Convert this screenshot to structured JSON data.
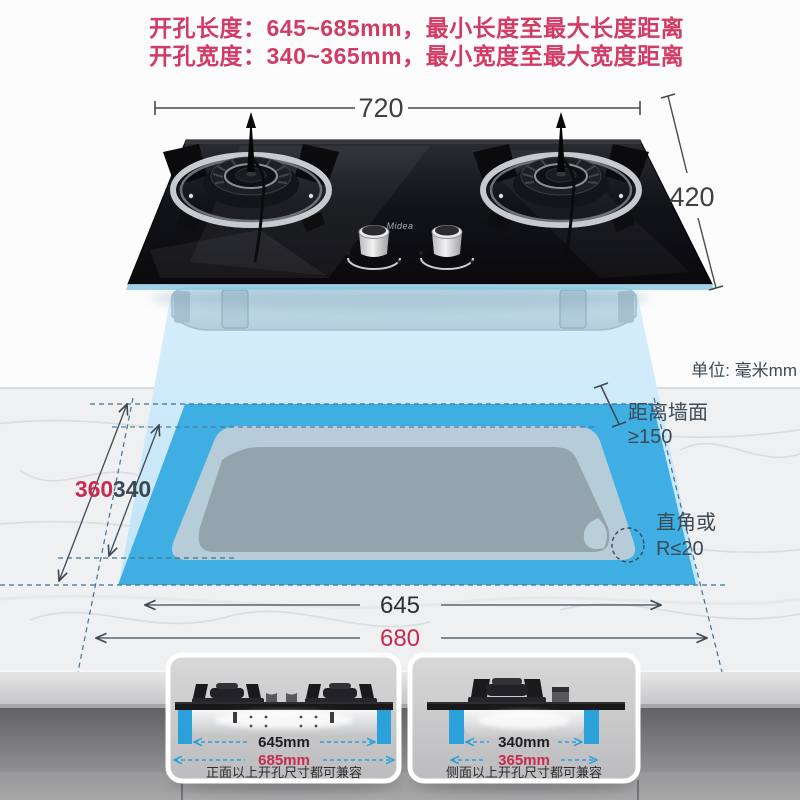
{
  "header": {
    "line1": "开孔长度：645~685mm，最小长度至最大长度距离",
    "line2": "开孔宽度：340~365mm，最小宽度至最大宽度距离"
  },
  "stove": {
    "width_label": "720",
    "depth_label": "420",
    "brand": "Midea"
  },
  "cutout": {
    "unit_label": "单位: 毫米mm",
    "wall_distance_label": "距离墙面",
    "wall_distance_value": "≥150",
    "corner_label": "直角或",
    "corner_value": "R≤20",
    "width_max": "360",
    "width_min": "340",
    "length_min": "645",
    "length_max": "680"
  },
  "insets": {
    "front": {
      "dim_min": "645mm",
      "dim_max": "685mm",
      "caption": "正面以上开孔尺寸都可兼容"
    },
    "side": {
      "dim_min": "340mm",
      "dim_max": "365mm",
      "caption": "侧面以上开孔尺寸都可兼容"
    }
  },
  "colors": {
    "header_red": "#d23b64",
    "dimension_red": "#c92a50",
    "accent_blue": "#2ba0da",
    "cutout_blue": "#3fafe3",
    "projection_blue": "#cfe9fa",
    "dim_dark": "#3d4a55"
  }
}
